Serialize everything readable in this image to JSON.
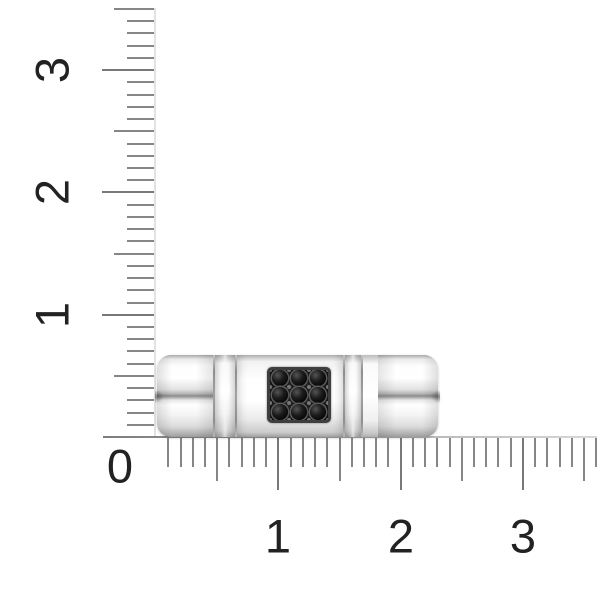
{
  "scene": {
    "background": "#ffffff"
  },
  "ruler": {
    "unit_px": 122.3,
    "minor_per_unit": 10,
    "origin_x": 156,
    "origin_y": 437,
    "tick_color": "#868686",
    "label_color": "#222222",
    "origin_label": "0",
    "vertical": {
      "min": 0,
      "max": 3.5,
      "labels": [
        "1",
        "2",
        "3"
      ]
    },
    "horizontal": {
      "min": 0,
      "max": 3.6,
      "labels": [
        "1",
        "2",
        "3"
      ]
    }
  },
  "ring": {
    "band_color": "#f4f4f4",
    "groove_color": "#8c8c8c",
    "stone_grid": {
      "rows": 3,
      "cols": 3,
      "stone_count": 9,
      "stone_color": "#111111",
      "setting_color": "#2c2c2c",
      "prong_color": "#7a7a7a"
    }
  }
}
